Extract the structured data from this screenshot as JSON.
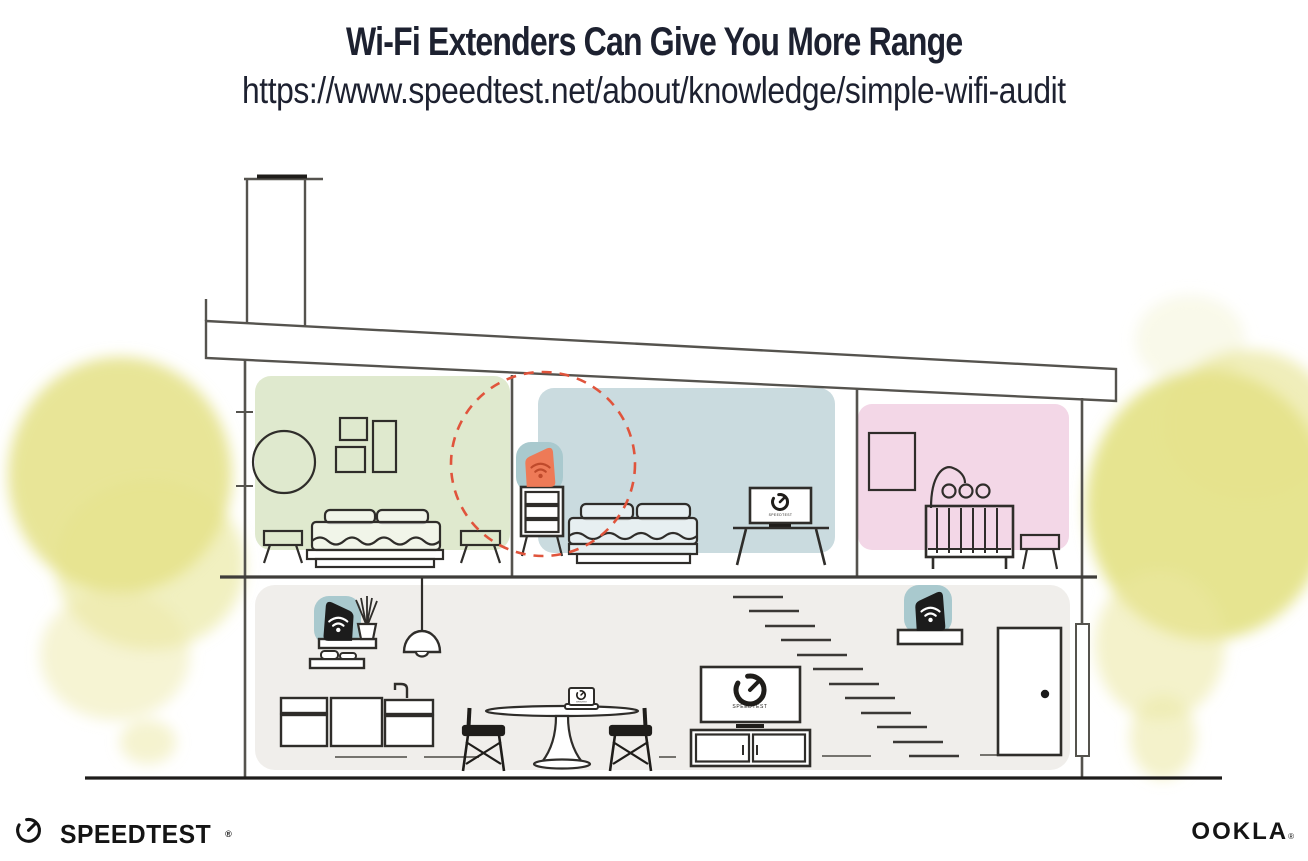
{
  "header": {
    "title": "Wi-Fi Extenders Can Give You More Range",
    "url": "https://www.speedtest.net/about/knowledge/simple-wifi-audit"
  },
  "footer": {
    "speedtest_logo": "SPEEDTEST",
    "speedtest_mark": "®",
    "ookla_logo": "OOKLA",
    "ookla_mark": "®"
  },
  "illustration": {
    "tv_label": "SPEEDTEST",
    "colors": {
      "coverage_dash": "#e0543c",
      "extender_body": "#ee7a57",
      "extender_icon": "#bf4a2b",
      "device_halo": "#a9c9ce",
      "router_body": "#1c1c1c",
      "router_icon": "#ffffff",
      "master_bedroom_bg": "#dfe9ce",
      "blue_bedroom_bg": "#cadbdf",
      "nursery_bg": "#f3d7e7",
      "ground_floor_bg": "#f0eeeb",
      "foliage": "#e2df7d",
      "structure_line": "#55534e",
      "furniture_line": "#2f2d2a"
    }
  }
}
